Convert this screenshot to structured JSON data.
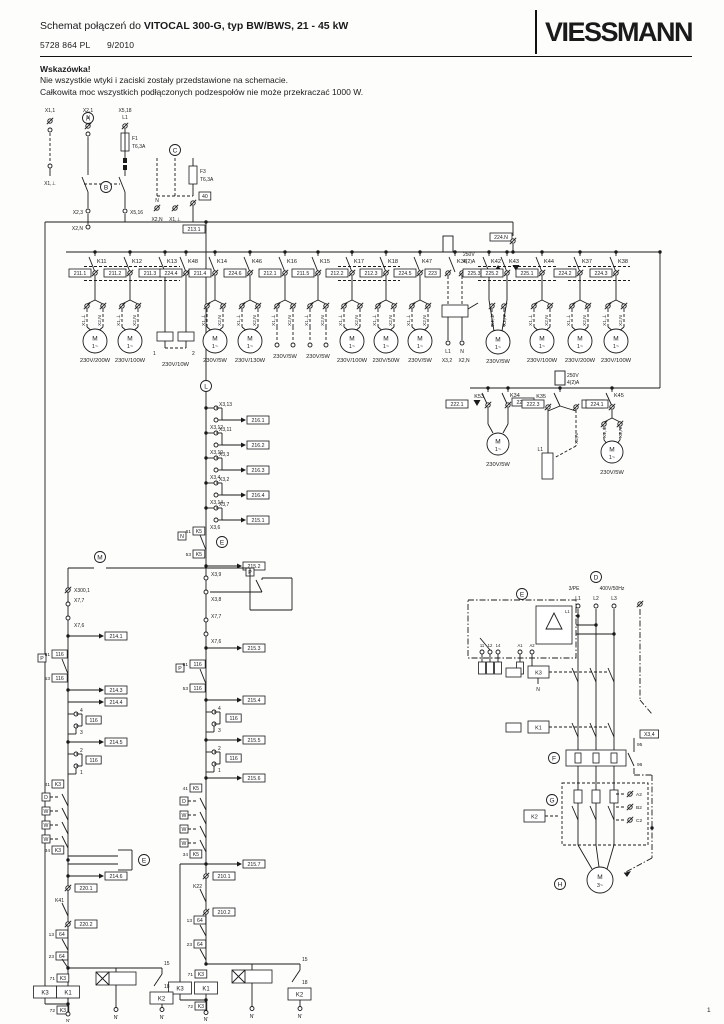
{
  "header": {
    "title_prefix": "Schemat połączeń do ",
    "title_product": "VITOCAL 300-G",
    "title_suffix": ", typ BW/BWS, 21 - 45 kW",
    "doc_number": "5728 864 PL",
    "doc_date": "9/2010",
    "logo": "VIESSMANN",
    "page_number": "1"
  },
  "note": {
    "heading": "Wskazówka!",
    "line1": "Nie wszystkie wtyki i zaciski zostały przedstawione na schemacie.",
    "line2": "Całkowita moc wszystkich podłączonych podzespołów nie może przekraczać 1000 W."
  },
  "term": {
    "earth": "X1,⊥",
    "neutral": "X2,N",
    "motor_m": "M",
    "motor_1ph": "1~",
    "motor_3ph": "3~",
    "n_prime": "N'"
  },
  "supply": {
    "a": "A",
    "b": "B",
    "c": "C",
    "x1_1": "X1,1",
    "x2_1": "X2,1",
    "n": "N",
    "x5_18": "X5,18",
    "l1": "L1",
    "f1": "F1",
    "f1_rating": "T6,3A",
    "x1_e": "X1,⊥",
    "x2_3": "X2,3",
    "x5_16": "X5,16",
    "x2_n": "X2,N",
    "f3": "F3",
    "f3_rating": "T6,3A",
    "box40": "40",
    "c_n": "N",
    "c_x2n": "X2,N",
    "c_x1e": "X1,⊥",
    "bus_box": "213.1",
    "bus_box_right": "224.N"
  },
  "main_row": [
    {
      "relay": "K11",
      "label": "211.1",
      "load": "motor",
      "rating": "230V/200W"
    },
    {
      "relay": "K12",
      "label": "211.2",
      "load": "motor",
      "rating": "230V/100W"
    },
    {
      "relay": "K13",
      "label": "211.3",
      "load": "res",
      "num": "1"
    },
    {
      "relay": "K48",
      "label": "224.4",
      "load": "res",
      "num": "2",
      "rating": "230V/10W"
    },
    {
      "relay": "K14",
      "label": "211.4",
      "load": "motor",
      "rating": "230V/5W"
    },
    {
      "relay": "K46",
      "label": "224.6",
      "load": "motor",
      "rating": "230V/130W"
    },
    {
      "relay": "K16",
      "label": "212.1",
      "load": "terms",
      "rating": "230V/5W"
    },
    {
      "relay": "K15",
      "label": "211.5",
      "load": "terms",
      "rating": "230V/5W"
    },
    {
      "relay": "K17",
      "label": "212.2",
      "load": "motor",
      "rating": "230V/100W"
    },
    {
      "relay": "K18",
      "label": "212.3",
      "load": "motor",
      "rating": "230V/50W"
    },
    {
      "relay": "K47",
      "label": "224.5",
      "load": "motor",
      "rating": "230V/5W"
    },
    {
      "relay": "K36",
      "label": "223",
      "load": "switch",
      "r1": "250V",
      "r2": "4(2)A",
      "sub_l1": "L1",
      "sub_n": "N",
      "sub_x32": "X3,2",
      "sub_x2n": "X2,N"
    },
    {
      "relay": "K42",
      "label": "225.3",
      "load": "shareL",
      "marker": "up"
    },
    {
      "relay": "K43",
      "label": "225.2",
      "load": "shareR",
      "marker": "down",
      "rating": "230V/5W"
    },
    {
      "relay": "K44",
      "label": "225.1",
      "load": "motor",
      "rating": "230V/100W"
    },
    {
      "relay": "K37",
      "label": "224.2",
      "load": "motor",
      "rating": "230V/200W"
    },
    {
      "relay": "K38",
      "label": "224.3",
      "load": "motor",
      "rating": "230V/100W"
    }
  ],
  "row2": {
    "branches": [
      {
        "relay": "K53",
        "label": "222.1",
        "marker": "down"
      },
      {
        "relay": "K34",
        "label": "222.2",
        "marker": "up",
        "rating": "230V/5W"
      },
      {
        "relay": "K35",
        "label": "222.3",
        "label2": "222.4",
        "r1": "250V",
        "r2": "4(2)A",
        "sub": "L1"
      },
      {
        "relay": "K45",
        "label": "224.1",
        "rating": "230V/5W"
      }
    ]
  },
  "mid_ladder": {
    "head": "L",
    "taps": [
      {
        "a": "X3,13",
        "b": "X3,12",
        "out": "216.1"
      },
      {
        "a": "X3,11",
        "b": "X3,10",
        "out": "216.2"
      },
      {
        "a": "X3,3",
        "b": "X3,4",
        "out": "216.3"
      },
      {
        "a": "X3,2",
        "b": "X3,14",
        "out": "216.4"
      },
      {
        "a": "X3,7",
        "b": "X3,6",
        "out": "215.1"
      }
    ],
    "k5": {
      "side_box": "N",
      "head": "E",
      "top": "61",
      "dev": "K5",
      "bot": "53",
      "out": "215.2"
    },
    "pair_p": {
      "a": "X3,9",
      "b": "X3,8",
      "p": "P"
    },
    "pair_x7": {
      "a": "X7,7",
      "b": "X7,6",
      "out": "215.3"
    },
    "c116": {
      "p": "P",
      "top": "61",
      "dev": "116",
      "bot": "53",
      "out": "215.4"
    },
    "tap43": {
      "a": "4",
      "b": "3",
      "dev": "116",
      "out": "215.5"
    },
    "tap21": {
      "a": "2",
      "b": "1",
      "dev": "116"
    },
    "out6": "215.6",
    "series": {
      "top": "41",
      "dev": "K5",
      "glyphs": [
        "D",
        "W",
        "W",
        "W"
      ],
      "bot": "34",
      "out": "215.7"
    },
    "t210a": "210.1",
    "k22": "K22",
    "t210b": "210.2",
    "c64a": {
      "top": "13",
      "dev": "64"
    },
    "c64b": {
      "top": "23",
      "dev": "64"
    }
  },
  "left_ladder": {
    "head": "M",
    "x300": "X300,1",
    "pair_x7": {
      "a": "X7,7",
      "b": "X7,6",
      "out": "214.1"
    },
    "c116": {
      "p": "P",
      "top": "61",
      "dev": "116",
      "bot": "53",
      "out": "214.3",
      "out2": "214.4"
    },
    "tap43": {
      "a": "4",
      "b": "3",
      "dev": "116",
      "out": "214.5"
    },
    "tap21": {
      "a": "2",
      "b": "1",
      "dev": "116"
    },
    "series": {
      "top": "41",
      "dev": "K3",
      "glyphs": [
        "D",
        "W",
        "W",
        "W"
      ],
      "bot": "34",
      "head": "E",
      "out": "214.6"
    },
    "t220a": "220.1",
    "k41": "K41",
    "t220b": "220.2",
    "c64a": {
      "top": "13",
      "dev": "64"
    },
    "c64b": {
      "top": "23",
      "dev": "64"
    }
  },
  "bottom": {
    "k3": "K3",
    "k1": "K1",
    "k2": "K2",
    "t15": "15",
    "t18": "18",
    "pre": "71",
    "pre_box": "K3",
    "post": "72",
    "post_box": "K3"
  },
  "power": {
    "d": "D",
    "sys": "3/PE",
    "volt": "400V/50Hz",
    "l1": "L1",
    "l2": "L2",
    "l3": "L3",
    "e": "E",
    "t11": "11",
    "t12": "12",
    "t14": "14",
    "a1": "A1",
    "a2": "A2",
    "mon_n": "N",
    "mon_l1": "L1",
    "k3": "K3",
    "k3_n": "N",
    "k1": "K1",
    "f": "F",
    "c95": "95",
    "c96": "96",
    "fx": "X3,4",
    "g": "G",
    "ph_a": "A2",
    "ph_b": "B2",
    "ph_c": "C2",
    "k2": "K2",
    "h": "H"
  }
}
